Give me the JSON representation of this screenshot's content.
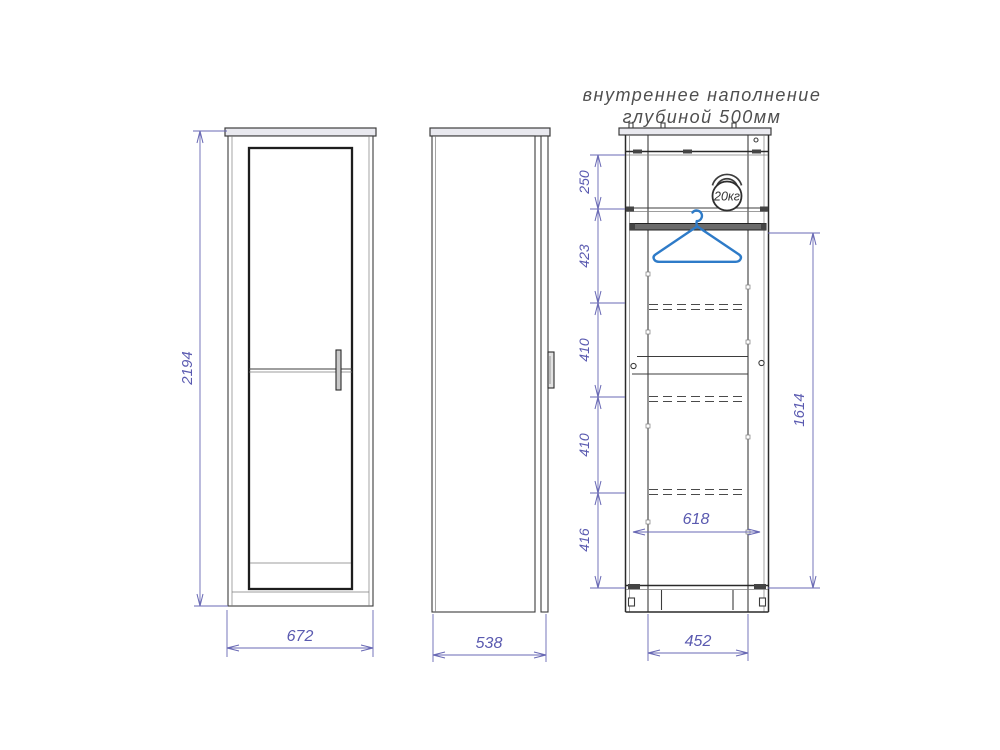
{
  "title": {
    "line1": "внутреннее наполнение",
    "line2": "глубиной 500мм"
  },
  "views": {
    "front": {
      "height": "2194",
      "width": "672"
    },
    "side": {
      "width": "538"
    },
    "interior": {
      "weight_capacity": "20кг",
      "top_section": "250",
      "hanging_section": "423",
      "shelf_section_1": "410",
      "shelf_section_2": "410",
      "bottom_section": "416",
      "hanging_height": "1614",
      "inner_width": "618",
      "base_width": "452"
    }
  },
  "colors": {
    "drawing_line": "#3d3d3d",
    "dimension": "#6868b4",
    "hanger_accent": "#2e7bc8",
    "panel_fill": "#e9e9ef",
    "title_text": "#4f4f4f"
  }
}
